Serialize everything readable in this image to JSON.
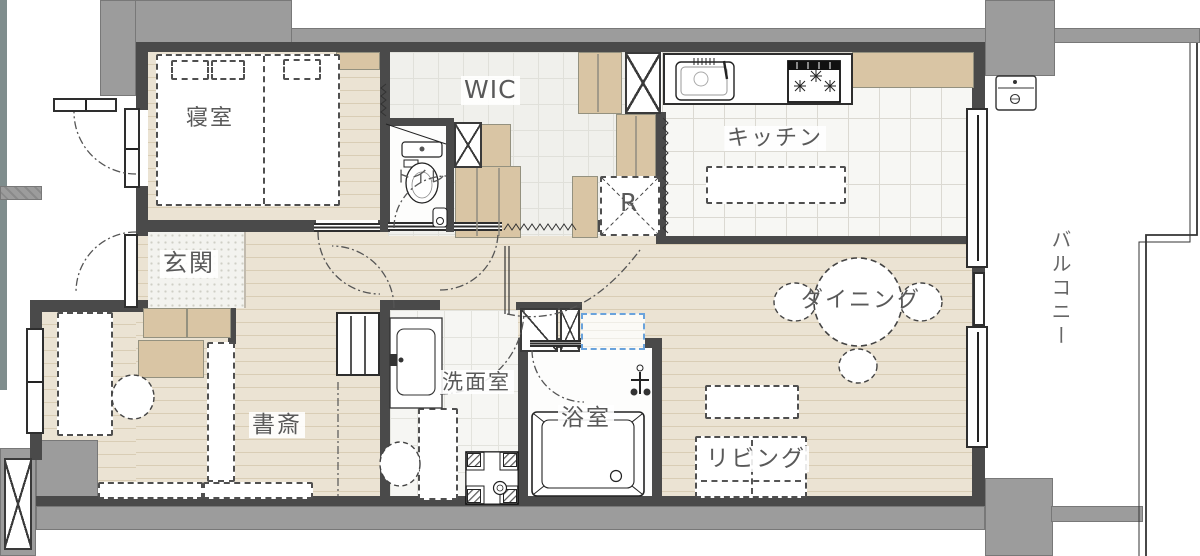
{
  "rooms": {
    "bedroom": {
      "label": "寝室"
    },
    "wic": {
      "label": "WIC"
    },
    "toilet": {
      "label": "トイレ"
    },
    "kitchen": {
      "label": "キッチン"
    },
    "fridge": {
      "label": "R"
    },
    "entrance": {
      "label": "玄関"
    },
    "dining": {
      "label": "ダイニング"
    },
    "study": {
      "label": "書斎"
    },
    "washroom": {
      "label": "洗面室"
    },
    "bath": {
      "label": "浴室"
    },
    "living": {
      "label": "リビング"
    },
    "balcony": {
      "label": "バルコニー"
    }
  },
  "colors": {
    "exterior_wall": "#9c9c9c",
    "interior_wall": "#4a4a4a",
    "wood_floor": "#ebe3d3",
    "cabinet": "#d9c5a4",
    "highlight_box": "#6aa3dc",
    "label_text": "#595959"
  }
}
